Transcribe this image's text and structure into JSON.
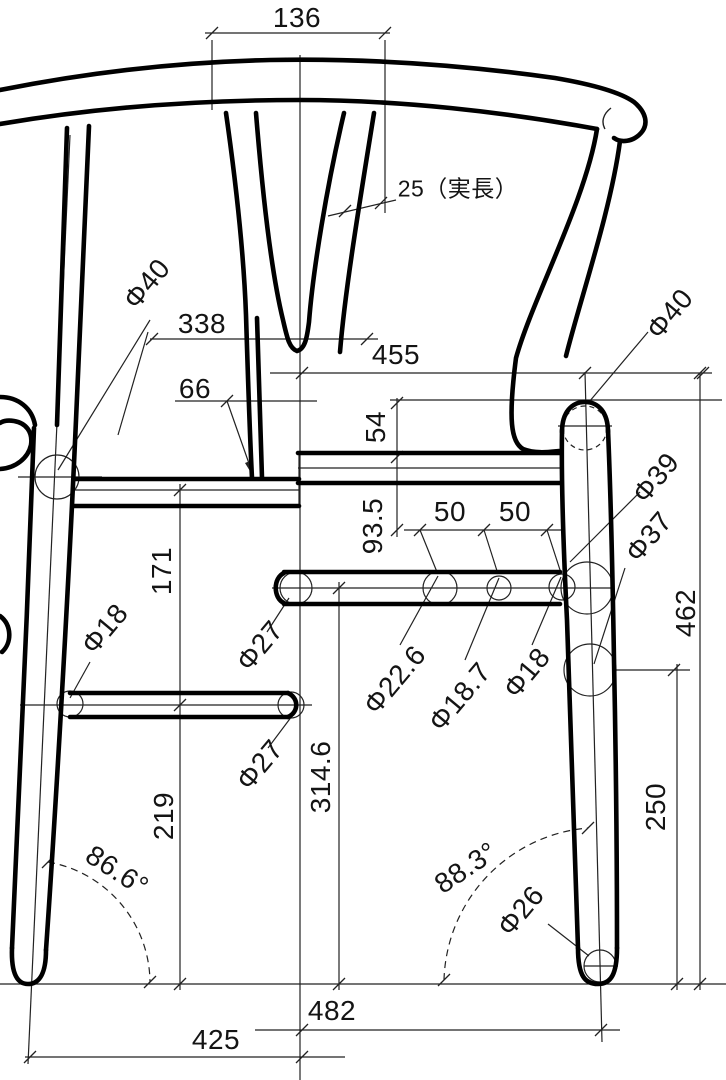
{
  "drawing": {
    "kind": "chair-dimension-drawing",
    "units": "mm",
    "line_color": "#000000",
    "background": "#ffffff",
    "dims": {
      "d136": "136",
      "d25": "25（実長）",
      "d338": "338",
      "d455": "455",
      "d66": "66",
      "d54": "54",
      "d93_5": "93.5",
      "d50a": "50",
      "d50b": "50",
      "d171": "171",
      "d314_6": "314.6",
      "d219": "219",
      "d250": "250",
      "d462": "462",
      "d482": "482",
      "d425": "425",
      "a86_6": "86.6°",
      "a88_3": "88.3°",
      "phi40L": "Φ40",
      "phi40R": "Φ40",
      "phi39": "Φ39",
      "phi37": "Φ37",
      "phi27U": "Φ27",
      "phi27L": "Φ27",
      "phi22_6": "Φ22.6",
      "phi18_7": "Φ18.7",
      "phi18L": "Φ18",
      "phi18R": "Φ18",
      "phi26": "Φ26"
    }
  }
}
